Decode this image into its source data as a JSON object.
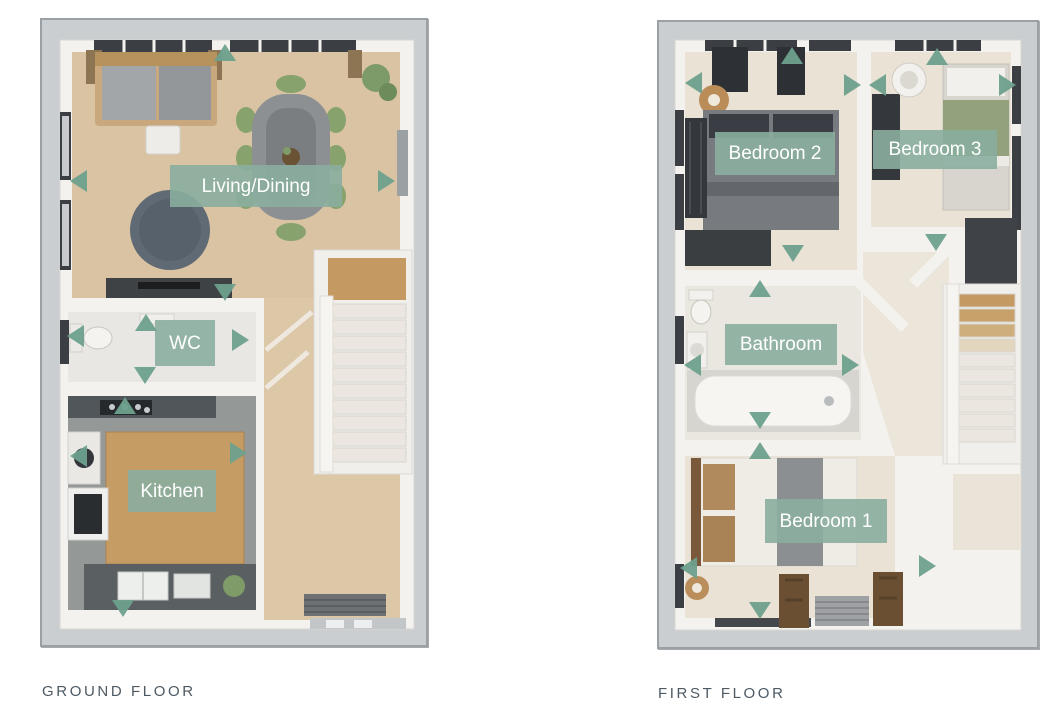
{
  "theme": {
    "accent_teal": "#6ea08d",
    "room_label_background": "#8aaf9e",
    "room_label_text_color": "#ffffff",
    "caption_color": "#4d5963",
    "plan_frame_border": "#9aa0a4",
    "plan_exterior_gray": "#cbced0",
    "page_background": "#ffffff"
  },
  "icons": {
    "direction_arrow": "filled-triangle"
  },
  "plans": [
    {
      "id": "ground-floor",
      "caption": "GROUND FLOOR",
      "rooms": [
        {
          "label": "Living/Dining"
        },
        {
          "label": "WC"
        },
        {
          "label": "Kitchen"
        }
      ]
    },
    {
      "id": "first-floor",
      "caption": "FIRST FLOOR",
      "rooms": [
        {
          "label": "Bedroom 2"
        },
        {
          "label": "Bedroom 3"
        },
        {
          "label": "Bathroom"
        },
        {
          "label": "Bedroom 1"
        }
      ]
    }
  ]
}
